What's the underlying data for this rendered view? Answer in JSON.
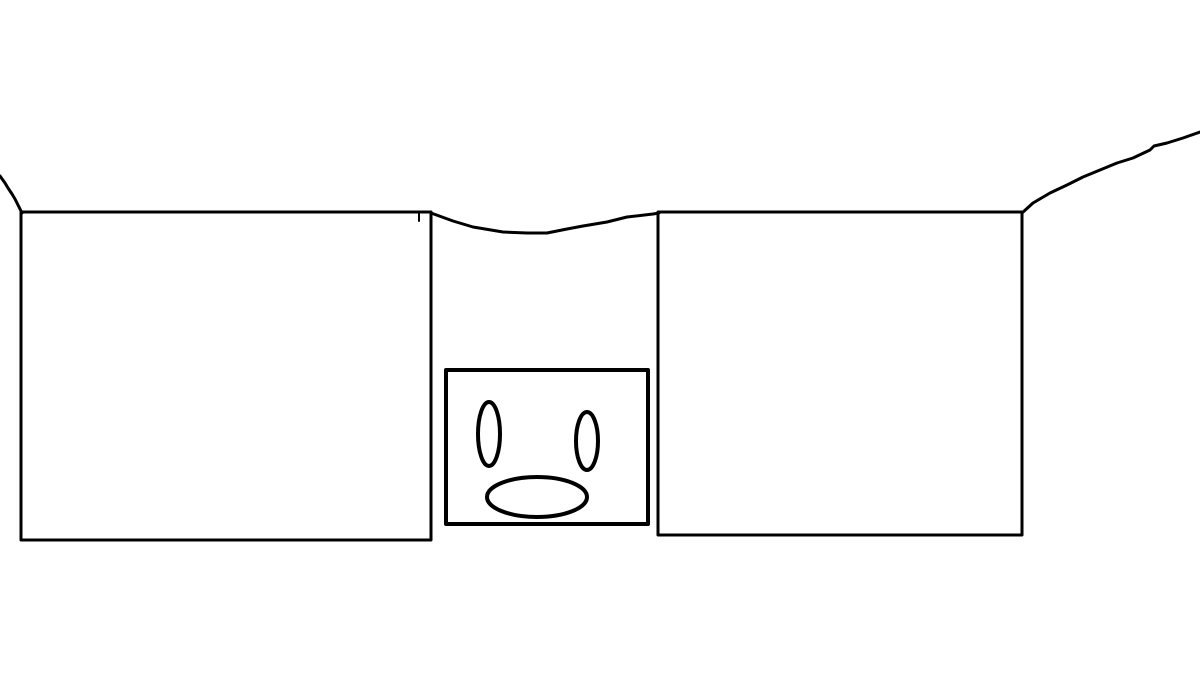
{
  "canvas": {
    "width": 1200,
    "height": 676,
    "background_color": "#ffffff",
    "stroke_color": "#000000"
  },
  "drawing": {
    "rectangles": [
      {
        "name": "left-large-rectangle",
        "x": 21,
        "y": 212,
        "width": 410,
        "height": 328,
        "stroke_width": 3
      },
      {
        "name": "right-large-rectangle",
        "x": 658,
        "y": 212,
        "width": 364,
        "height": 323,
        "stroke_width": 3
      },
      {
        "name": "face-box-rectangle",
        "x": 446,
        "y": 370,
        "width": 202,
        "height": 154,
        "stroke_width": 4
      }
    ],
    "ellipses": [
      {
        "name": "face-left-eye",
        "cx": 489,
        "cy": 434,
        "rx": 11,
        "ry": 32,
        "stroke_width": 4
      },
      {
        "name": "face-right-eye",
        "cx": 587,
        "cy": 441,
        "rx": 11,
        "ry": 29,
        "stroke_width": 4
      },
      {
        "name": "face-mouth",
        "cx": 537,
        "cy": 497,
        "rx": 50,
        "ry": 20,
        "stroke_width": 4
      }
    ],
    "polylines": [
      {
        "name": "top-left-squiggle",
        "stroke_width": 3,
        "points": [
          [
            0,
            176
          ],
          [
            5,
            183
          ],
          [
            8,
            188
          ],
          [
            12,
            194
          ],
          [
            15,
            199
          ],
          [
            18,
            205
          ],
          [
            22,
            213
          ]
        ]
      },
      {
        "name": "center-dip-line",
        "stroke_width": 3,
        "points": [
          [
            431,
            213
          ],
          [
            453,
            221
          ],
          [
            473,
            227
          ],
          [
            503,
            232
          ],
          [
            527,
            233
          ],
          [
            547,
            233
          ],
          [
            567,
            229
          ],
          [
            583,
            226
          ],
          [
            607,
            222
          ],
          [
            627,
            217
          ],
          [
            653,
            214
          ],
          [
            659,
            213
          ]
        ]
      },
      {
        "name": "small-tick-mark",
        "stroke_width": 2,
        "points": [
          [
            419,
            213
          ],
          [
            419,
            221
          ]
        ]
      },
      {
        "name": "right-rising-curve",
        "stroke_width": 3,
        "points": [
          [
            1022,
            213
          ],
          [
            1033,
            203
          ],
          [
            1050,
            193
          ],
          [
            1067,
            185
          ],
          [
            1083,
            177
          ],
          [
            1100,
            170
          ],
          [
            1117,
            163
          ],
          [
            1133,
            158
          ],
          [
            1150,
            150
          ],
          [
            1154,
            146
          ],
          [
            1167,
            143
          ],
          [
            1183,
            138
          ],
          [
            1200,
            132
          ]
        ]
      }
    ]
  }
}
